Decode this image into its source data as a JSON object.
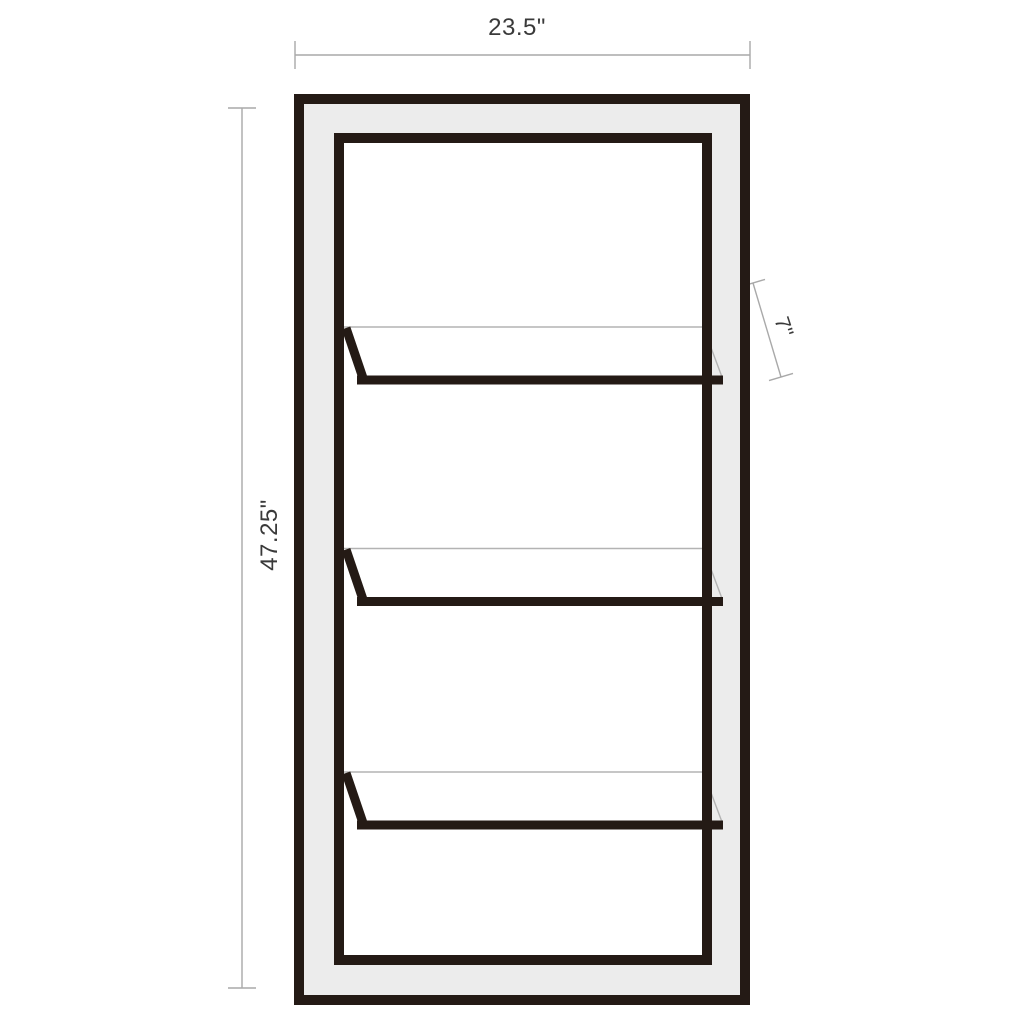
{
  "labels": {
    "width": "23.5\"",
    "height": "47.25\"",
    "shelf_depth": "7\""
  },
  "shelves": {
    "count": 3
  },
  "colors": {
    "frame": "#241a15",
    "frame_fill": "#ececec",
    "interior_fill": "#ffffff",
    "dimension_line": "#a9a9a9",
    "shelf_back_edge": "#b3b3b3",
    "label_text": "#3a3a3a",
    "background": "#ffffff"
  }
}
